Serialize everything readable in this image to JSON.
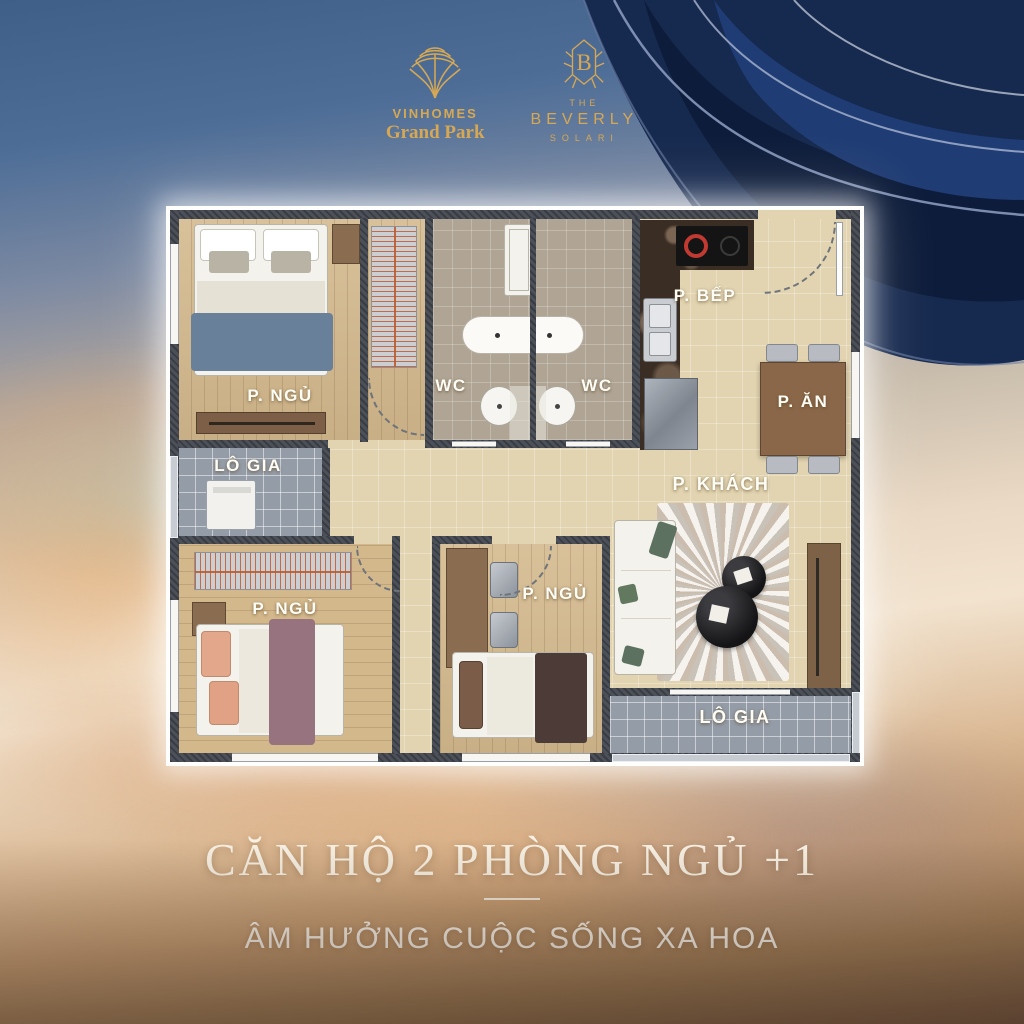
{
  "branding": {
    "vinhomes": {
      "name": "VINHOMES",
      "subname": "Grand Park"
    },
    "beverly": {
      "the": "THE",
      "name": "BEVERLY",
      "subname": "SOLARI",
      "monogram": "B"
    }
  },
  "floorplan": {
    "labels": {
      "bedroom1": "P. NGỦ",
      "loggia_left": "LÔ GIA",
      "wc_left": "WC",
      "wc_right": "WC",
      "kitchen": "P. BẾP",
      "dining": "P. ĂN",
      "living": "P. KHÁCH",
      "bedroom2": "P. NGỦ",
      "bedroom3": "P. NGỦ",
      "loggia_right": "LÔ GIA"
    }
  },
  "footer": {
    "title": "CĂN HỘ 2 PHÒNG NGỦ +1",
    "subtitle": "ÂM HƯỞNG CUỘC SỐNG XA HOA"
  },
  "colors": {
    "gold": "#d7a854",
    "navy": "#16294e",
    "label_text": "#fdfdf6",
    "sky_blue": "#4d6d97",
    "sunset_peach": "#ddbd9a"
  }
}
